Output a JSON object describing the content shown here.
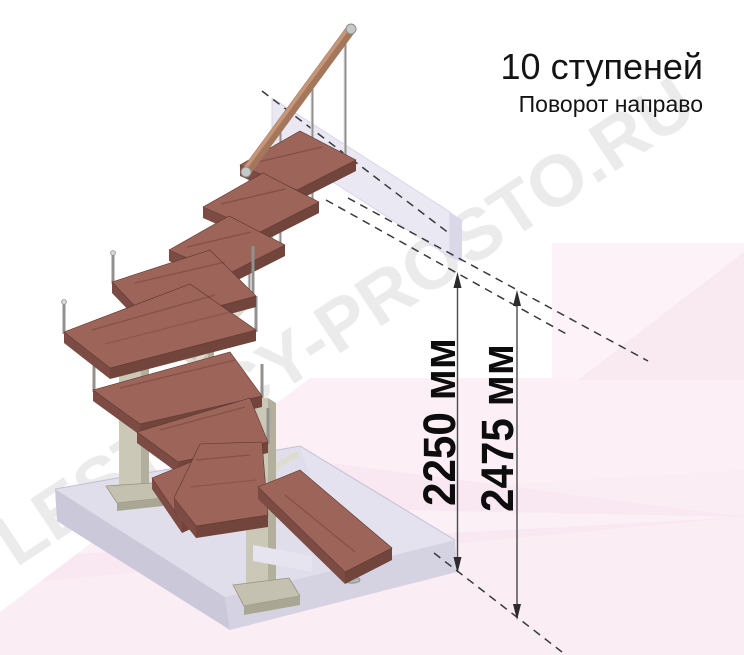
{
  "header": {
    "title": "10 ступеней",
    "subtitle": "Поворот направо"
  },
  "watermark": {
    "text": "LESTNICY-PROSTO.RU"
  },
  "dimensions": [
    {
      "id": "inner-height",
      "label": "2250 мм"
    },
    {
      "id": "outer-height",
      "label": "2475 мм"
    }
  ],
  "diagram": {
    "type": "3d-staircase-render",
    "steps_count": 10,
    "turn_direction": "направо",
    "colors": {
      "tread_top": "#9d6459",
      "tread_side": "#7c4c44",
      "handrail_wood": "#a4765c",
      "metal_baluster": "#93918f",
      "support_column": "#ccc8b7",
      "floor_slab": "#e0deea",
      "upper_panel": "#e9e8f3",
      "background_pink": "#fcf0f6",
      "text": "#141414"
    }
  }
}
